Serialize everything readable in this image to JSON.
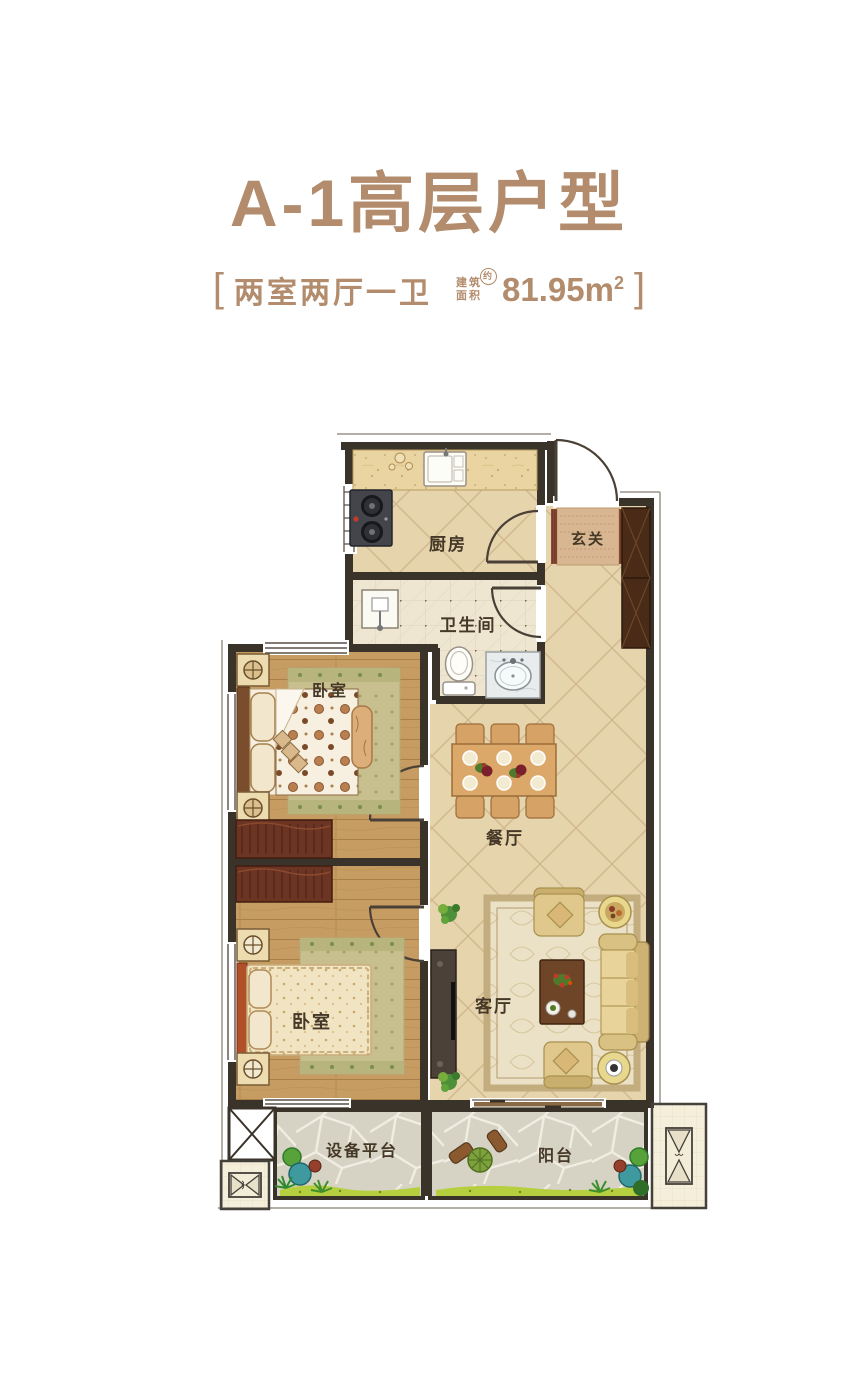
{
  "header": {
    "title": "A-1高层户型",
    "bracket_left": "[",
    "bracket_right": "]",
    "layout_text": "两室两厅一卫",
    "area_prefix_line1": "建筑",
    "area_prefix_line2": "面积",
    "area_approx_badge": "约",
    "area_value": "81.95m",
    "area_unit_sup": "2",
    "accent_color": "#b28c6c"
  },
  "floorplan": {
    "room_labels": {
      "kitchen": "厨房",
      "foyer": "玄关",
      "bathroom": "卫生间",
      "bedroom_top": "卧室",
      "bedroom_bottom": "卧室",
      "dining": "餐厅",
      "living": "客厅",
      "equipment_platform": "设备平台",
      "balcony": "阳台"
    },
    "icons": {
      "ac_outdoor_unit": "bowtie-rect-symbol",
      "shaft_cross": "x-cross-box",
      "door_swing": "quarter-arc",
      "window": "parallel-lines"
    },
    "colors": {
      "wall": "#3a332a",
      "tile_floor": "#e6d4ad",
      "tile_line": "#cfb88e",
      "wood_floor": "#c69c62",
      "bath_floor": "#eee6d1",
      "balcony_floor": "#d7d3c4",
      "counter": "#e9d4a2",
      "dark_wood_furniture": "#4a2b17",
      "dresser": "#6b3423",
      "sofa": "#d9c083",
      "bed_linen": "#f6efdf",
      "rug_green": "#c8bf8f",
      "plant_green": "#57a33a",
      "grass": "#b5cf3f",
      "ac_floor": "#f4eedb",
      "headboard_accent": "#b14f28"
    }
  }
}
